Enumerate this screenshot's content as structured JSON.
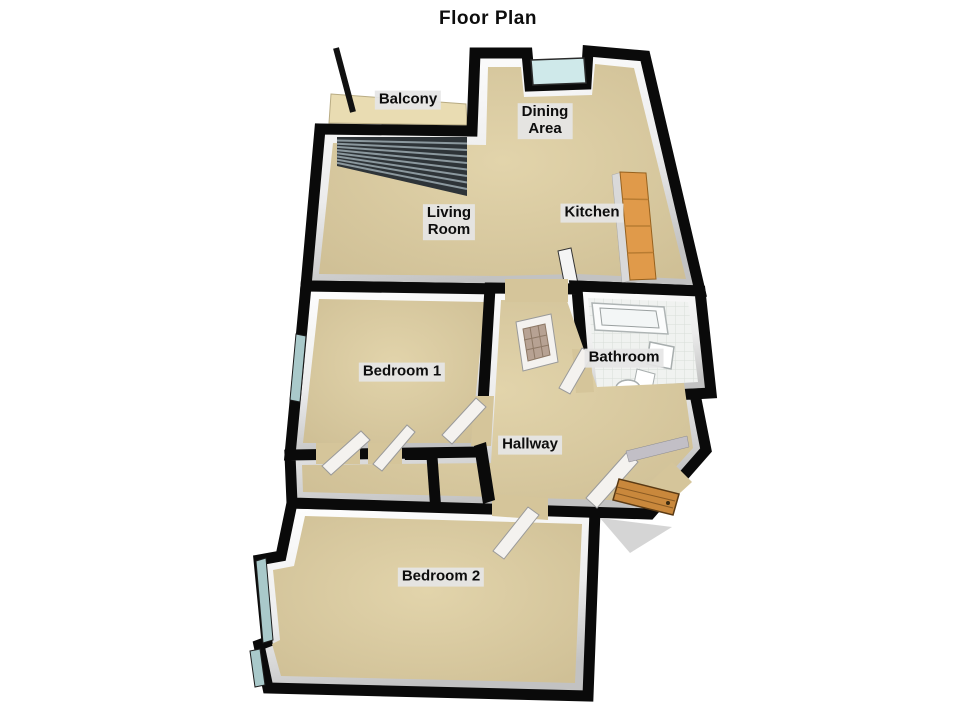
{
  "title": "Floor Plan",
  "labels": {
    "balcony": "Balcony",
    "dining": "Dining\nArea",
    "living": "Living\nRoom",
    "kitchen": "Kitchen",
    "bedroom1": "Bedroom 1",
    "bathroom": "Bathroom",
    "hallway": "Hallway",
    "bedroom2": "Bedroom 2"
  },
  "colors": {
    "background": "#ffffff",
    "wall": "#0a0a0a",
    "wall_face_light": "#ffffff",
    "wall_face_dark": "#c2c2c2",
    "floor_tan_light": "#e2d4ab",
    "floor_tan_dark": "#cdbd93",
    "balcony_floor": "#e9dcb2",
    "window_glass": "#a9c9ca",
    "bay_window_glass": "#cfe9ea",
    "bathroom_tile": "#f0f2f0",
    "kitchen_counter": "#e09a4a",
    "kitchen_cabinet": "#d9d9d9",
    "door_leaf": "#f4f2ef",
    "front_door_wood": "#c9883c",
    "sliding_door_dark": "#2e3438",
    "sliding_door_stripe": "#8b989e",
    "label_background": "#e5e5e5",
    "label_text": "#0d0d0d"
  }
}
